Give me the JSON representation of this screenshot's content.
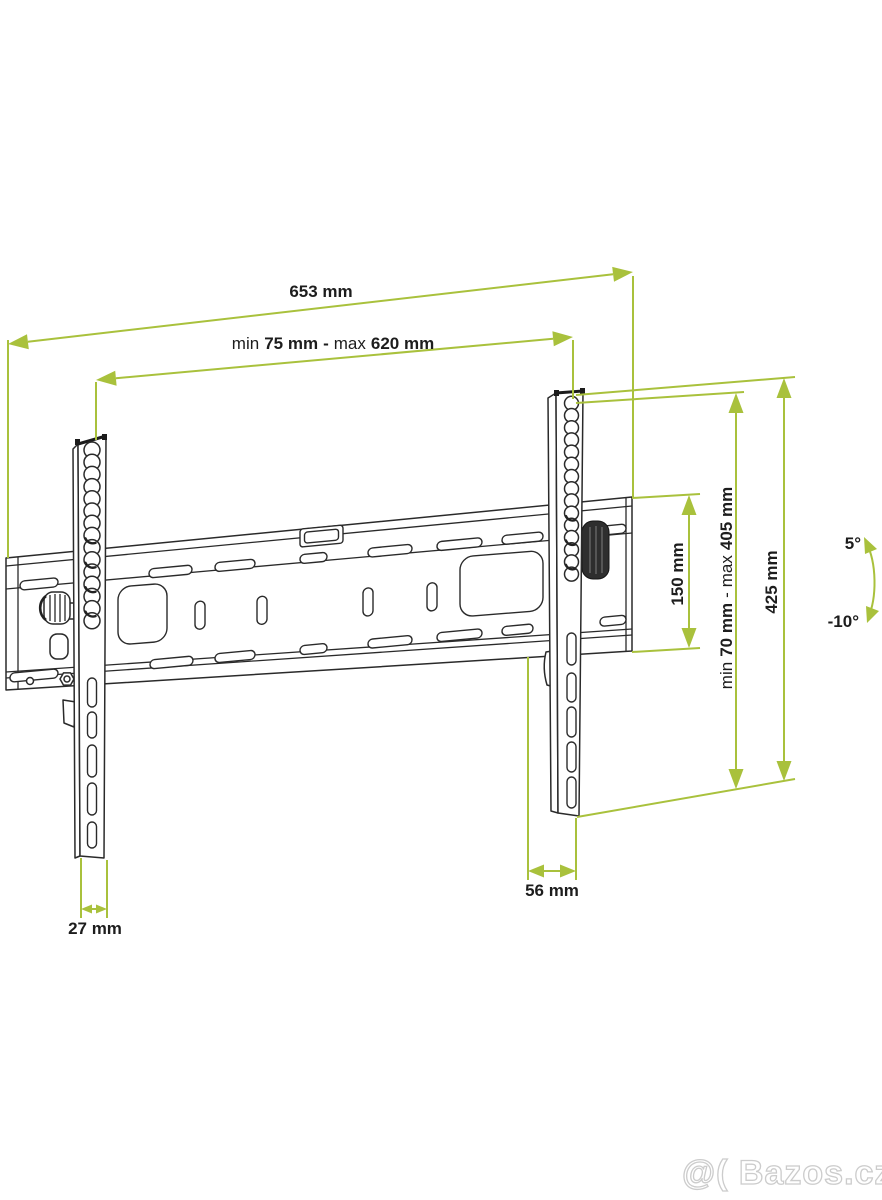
{
  "diagram": {
    "subject": "tilting TV wall mount bracket dimension drawing",
    "dimensions": {
      "total_width": "653 mm",
      "vesa_width": {
        "min_label": "min",
        "min_value": "75 mm",
        "separator": "-",
        "max_label": "max",
        "max_value": "620 mm"
      },
      "plate_height": "150 mm",
      "vesa_height": {
        "min_label": "min",
        "min_value": "70 mm",
        "separator": "-",
        "max_label": "max",
        "max_value": "405 mm"
      },
      "bracket_height": "425 mm",
      "bracket_depth": "56 mm",
      "bracket_width": "27 mm",
      "tilt_up": "5°",
      "tilt_down": "-10°"
    },
    "colors": {
      "dimension_green": "#a9c13c",
      "line_art": "#2a2a2a",
      "watermark_gray": "#cccccc"
    }
  },
  "watermark": "@( Bazos.cz"
}
